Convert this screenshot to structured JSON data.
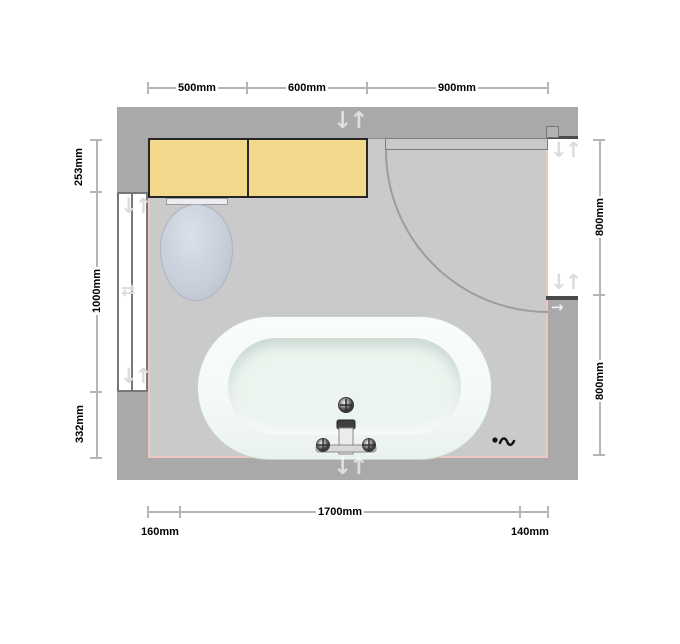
{
  "dimensions": {
    "top": [
      "500mm",
      "600mm",
      "900mm"
    ],
    "left": [
      "253mm",
      "1000mm",
      "332mm"
    ],
    "right": [
      "800mm",
      "800mm"
    ],
    "bottom_main": "1700mm",
    "bottom_left": "160mm",
    "bottom_right": "140mm"
  },
  "icons": {
    "handle_pair": "↓↑",
    "move_pair": "⇄",
    "arrow_right": "→"
  },
  "colors": {
    "wall": "#a9a9a9",
    "floor": "#cacaca",
    "floor_edge": "#eec6c2",
    "dim_line": "#b5b5b5",
    "dim_text": "#000000",
    "cabinet": "#f2d98c",
    "cabinet_border": "#262626",
    "window_frame": "#777777",
    "door_leaf": "#c9c9c9",
    "door_frame": "#4a4a4a",
    "arc": "#9d9d9d",
    "toilet": "#c6cdd9",
    "tub": "#f5faf7",
    "tub_inner": "#ecf4ef"
  }
}
